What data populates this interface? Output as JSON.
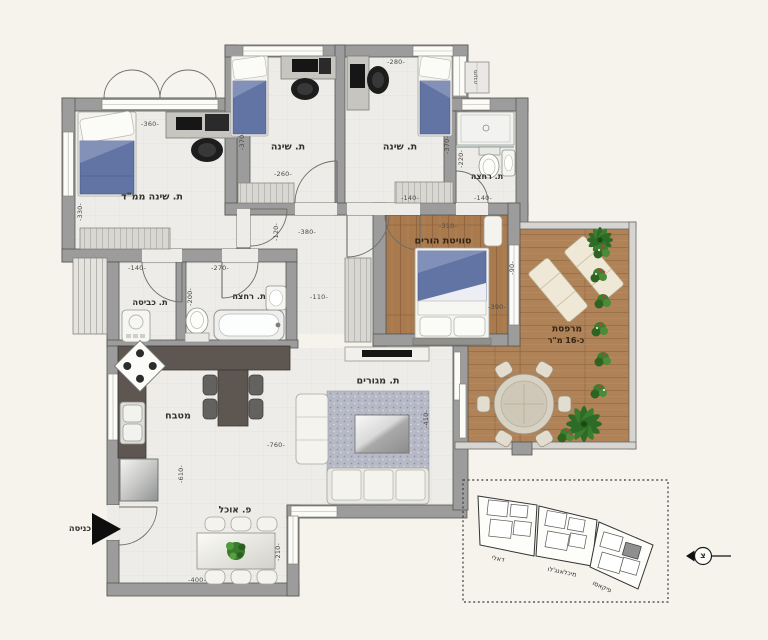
{
  "rooms": {
    "mamad": {
      "label": "ת. שינה ממ\"ד"
    },
    "bedroom1": {
      "label": "ת. שינה"
    },
    "bedroom2": {
      "label": "ת. שינה"
    },
    "bath_top": {
      "label": "ת. רחצה"
    },
    "suite": {
      "label": "סוויטת הורים"
    },
    "bath_mid": {
      "label": "ת. רחצה"
    },
    "laundry": {
      "label": "ת. כביסה"
    },
    "kitchen": {
      "label": "מטבח"
    },
    "living": {
      "label": "ת. מגורים"
    },
    "dining": {
      "label": "פ. אוכל"
    },
    "balcony": {
      "label": "מרפסת",
      "area_label": "כ-16 מ\"ר"
    }
  },
  "annotations": {
    "entrance": "כניסה",
    "condenser": "מעבה",
    "north": "צ"
  },
  "dims": {
    "mamad_w": "-360-",
    "mamad_h": "-330-",
    "laundry_w": "-140-",
    "bath_mid_w": "-270-",
    "wet_split": "-200-",
    "bedroom1_w": "-260-",
    "bedroom1_h": "-370-",
    "bedroom2_w": "-280-",
    "bedroom2_h": "-370-",
    "bath_top_h": "-220-",
    "bath_top_w": "-140-",
    "hall_w": "-380-",
    "hall_h": "-120-",
    "hall2_w": "-110-",
    "suite_door": "-140-",
    "suite_w": "-310-",
    "suite_h": "-390-",
    "suite_side": "-90-",
    "living_w": "-760-",
    "kitchen_h": "-610-",
    "living_h": "-410-",
    "dining_w": "-400-",
    "dining_h": "-210-"
  },
  "key_plan": {
    "buildings": [
      {
        "name": "דאלי"
      },
      {
        "name": "מיכלאנג'לו"
      },
      {
        "name": "פיקאסו"
      }
    ]
  },
  "colors": {
    "background": "#f5f3ec",
    "wall": "#9c9c9c",
    "wall_outline": "#555550",
    "floor": "#edece8",
    "wood": "#a87a4e",
    "deck": "#b08257",
    "counter": "#5d5651",
    "bed_blue": "#6274a3",
    "rug": "#b7bac6",
    "greenery": "#3f7d2e",
    "flower": "#c4374b",
    "arrow_black": "#111111"
  }
}
